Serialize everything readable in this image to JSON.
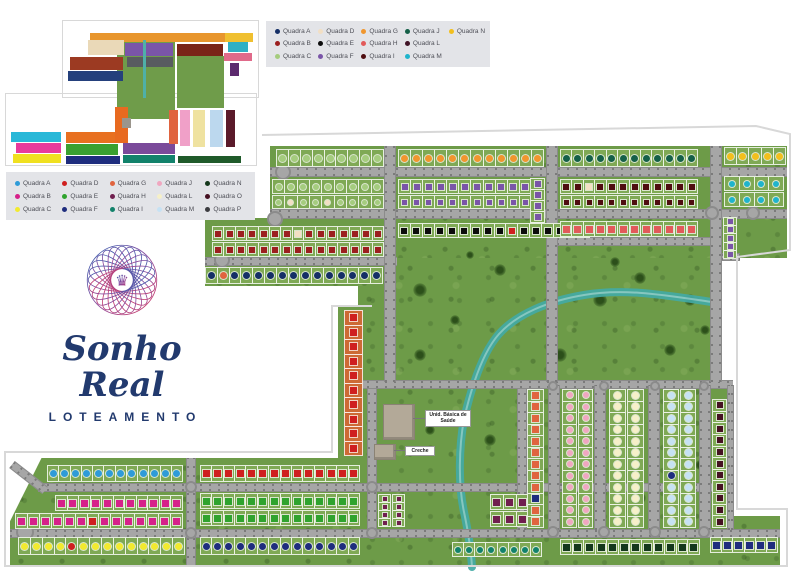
{
  "logo": {
    "title": "Sonho Real",
    "subtitle": "LOTEAMENTO",
    "accent": "#223a6e"
  },
  "map_labels": {
    "health_unit": "Unid. Básica de Saúde",
    "daycare": "Creche"
  },
  "legend_top": {
    "items": [
      {
        "label": "Quadra A",
        "color": "#152f66"
      },
      {
        "label": "Quadra B",
        "color": "#9c1f1f"
      },
      {
        "label": "Quadra C",
        "color": "#a5cc7e"
      },
      {
        "label": "Quadra D",
        "color": "#f2dfc4"
      },
      {
        "label": "Quadra E",
        "color": "#0c0c0c"
      },
      {
        "label": "Quadra F",
        "color": "#7a55a8"
      },
      {
        "label": "Quadra G",
        "color": "#f0962e"
      },
      {
        "label": "Quadra H",
        "color": "#e25a5a"
      },
      {
        "label": "Quadra I",
        "color": "#4f0d10"
      },
      {
        "label": "Quadra J",
        "color": "#156048"
      },
      {
        "label": "Quadra L",
        "color": "#401325"
      },
      {
        "label": "Quadra M",
        "color": "#1fb4cc"
      },
      {
        "label": "Quadra N",
        "color": "#f2bf1d"
      }
    ]
  },
  "legend_left": {
    "items": [
      {
        "label": "Quadra A",
        "color": "#2e9bd8"
      },
      {
        "label": "Quadra B",
        "color": "#d6218a"
      },
      {
        "label": "Quadra C",
        "color": "#f2ea2f"
      },
      {
        "label": "Quadra D",
        "color": "#cf1f1f"
      },
      {
        "label": "Quadra E",
        "color": "#2fa32e"
      },
      {
        "label": "Quadra F",
        "color": "#1f2d7e"
      },
      {
        "label": "Quadra G",
        "color": "#e0643f"
      },
      {
        "label": "Quadra H",
        "color": "#701f4f"
      },
      {
        "label": "Quadra I",
        "color": "#12826b"
      },
      {
        "label": "Quadra J",
        "color": "#f0a7c0"
      },
      {
        "label": "Quadra L",
        "color": "#f6f0c8"
      },
      {
        "label": "Quadra M",
        "color": "#c6e2f4"
      },
      {
        "label": "Quadra N",
        "color": "#14381c"
      },
      {
        "label": "Quadra O",
        "color": "#451122"
      },
      {
        "label": "Quadra P",
        "color": "#3c3c40"
      }
    ]
  },
  "inset": {
    "blocks": [
      {
        "color": "#6f9c4a",
        "x": 117,
        "y": 38,
        "w": 58,
        "h": 72
      },
      {
        "color": "#6f9c4a",
        "x": 177,
        "y": 56,
        "w": 47,
        "h": 52
      },
      {
        "color": "#6f9c4a",
        "x": 125,
        "y": 95,
        "w": 50,
        "h": 24
      },
      {
        "color": "#e8962e",
        "x": 90,
        "y": 33,
        "w": 135,
        "h": 9
      },
      {
        "color": "#f0c030",
        "x": 225,
        "y": 33,
        "w": 28,
        "h": 9
      },
      {
        "color": "#ead9b8",
        "x": 88,
        "y": 40,
        "w": 36,
        "h": 15
      },
      {
        "color": "#7a55a8",
        "x": 125,
        "y": 43,
        "w": 48,
        "h": 13
      },
      {
        "color": "#585c60",
        "x": 127,
        "y": 57,
        "w": 46,
        "h": 10
      },
      {
        "color": "#9c3a22",
        "x": 70,
        "y": 57,
        "w": 53,
        "h": 13
      },
      {
        "color": "#24407c",
        "x": 68,
        "y": 71,
        "w": 55,
        "h": 10
      },
      {
        "color": "#7a2418",
        "x": 177,
        "y": 44,
        "w": 46,
        "h": 12
      },
      {
        "color": "#2fb0c4",
        "x": 228,
        "y": 42,
        "w": 20,
        "h": 10
      },
      {
        "color": "#e06a8a",
        "x": 224,
        "y": 53,
        "w": 28,
        "h": 8
      },
      {
        "color": "#5c2a6e",
        "x": 230,
        "y": 63,
        "w": 9,
        "h": 13
      },
      {
        "color": "#4fb0a8",
        "x": 143,
        "y": 40,
        "w": 3,
        "h": 58
      },
      {
        "color": "#29b8d8",
        "x": 11,
        "y": 132,
        "w": 50,
        "h": 10
      },
      {
        "color": "#e83a9c",
        "x": 16,
        "y": 143,
        "w": 45,
        "h": 10
      },
      {
        "color": "#f0e020",
        "x": 13,
        "y": 154,
        "w": 48,
        "h": 9
      },
      {
        "color": "#e87020",
        "x": 66,
        "y": 132,
        "w": 52,
        "h": 11
      },
      {
        "color": "#3aa030",
        "x": 66,
        "y": 144,
        "w": 52,
        "h": 11
      },
      {
        "color": "#1f2d7e",
        "x": 66,
        "y": 156,
        "w": 54,
        "h": 8
      },
      {
        "color": "#e86a20",
        "x": 115,
        "y": 107,
        "w": 13,
        "h": 36
      },
      {
        "color": "#7a4a9a",
        "x": 123,
        "y": 143,
        "w": 52,
        "h": 11
      },
      {
        "color": "#12826b",
        "x": 123,
        "y": 155,
        "w": 52,
        "h": 8
      },
      {
        "color": "#e0643f",
        "x": 169,
        "y": 110,
        "w": 9,
        "h": 34
      },
      {
        "color": "#f0a0c8",
        "x": 180,
        "y": 110,
        "w": 10,
        "h": 36
      },
      {
        "color": "#efe2a0",
        "x": 193,
        "y": 110,
        "w": 12,
        "h": 37
      },
      {
        "color": "#bcd8ee",
        "x": 210,
        "y": 110,
        "w": 13,
        "h": 37
      },
      {
        "color": "#5a1a2a",
        "x": 226,
        "y": 110,
        "w": 9,
        "h": 37
      },
      {
        "color": "#1f5a2a",
        "x": 178,
        "y": 156,
        "w": 63,
        "h": 7
      },
      {
        "color": "#9a958c",
        "x": 122,
        "y": 118,
        "w": 9,
        "h": 10
      }
    ]
  },
  "map": {
    "colors": {
      "field": "#6d9b48",
      "road": "#a6a6a6",
      "river": "#43aaa5",
      "outline": "#d8d8d8"
    },
    "river_path": "M712,302 C664,295 624,288 584,295 C548,301 517,314 499,334 C482,353 471,389 464,419 C459,447 458,484 464,512 C468,531 471,550 472,567",
    "outline_path": "M262,135 L756,126 L790,134 L790,250 L737,257 L737,509 L787,509 L787,566 L5,566 L5,452 L332,452 L332,306 L372,306",
    "areas": [
      {
        "x": 270,
        "y": 146,
        "w": 517,
        "h": 112
      },
      {
        "x": 358,
        "y": 258,
        "w": 364,
        "h": 124
      },
      {
        "x": 205,
        "y": 218,
        "w": 182,
        "h": 68
      },
      {
        "x": 358,
        "y": 382,
        "w": 375,
        "h": 185
      },
      {
        "x": 10,
        "y": 458,
        "w": 350,
        "h": 109,
        "clip": "polygon(0 58%, 9% 0, 100% 0, 100% 100%, 0 100%)"
      },
      {
        "x": 338,
        "y": 306,
        "w": 28,
        "h": 152
      },
      {
        "x": 733,
        "y": 516,
        "w": 47,
        "h": 51
      }
    ],
    "trees": [
      {
        "x": 420,
        "y": 290,
        "r": 7
      },
      {
        "x": 455,
        "y": 320,
        "r": 5
      },
      {
        "x": 500,
        "y": 270,
        "r": 6
      },
      {
        "x": 470,
        "y": 255,
        "r": 4
      },
      {
        "x": 600,
        "y": 300,
        "r": 7
      },
      {
        "x": 640,
        "y": 278,
        "r": 6
      },
      {
        "x": 615,
        "y": 262,
        "r": 5
      },
      {
        "x": 690,
        "y": 300,
        "r": 6
      },
      {
        "x": 670,
        "y": 350,
        "r": 6
      },
      {
        "x": 560,
        "y": 355,
        "r": 7
      },
      {
        "x": 420,
        "y": 355,
        "r": 6
      },
      {
        "x": 390,
        "y": 335,
        "r": 5
      },
      {
        "x": 430,
        "y": 430,
        "r": 5
      },
      {
        "x": 490,
        "y": 440,
        "r": 6
      },
      {
        "x": 530,
        "y": 468,
        "r": 5
      },
      {
        "x": 600,
        "y": 458,
        "r": 6
      },
      {
        "x": 640,
        "y": 498,
        "r": 6
      },
      {
        "x": 615,
        "y": 430,
        "r": 4
      },
      {
        "x": 700,
        "y": 465,
        "r": 5
      },
      {
        "x": 705,
        "y": 330,
        "r": 5
      }
    ],
    "roads": [
      {
        "x": 270,
        "y": 167,
        "w": 517,
        "h": 10,
        "dir": "h"
      },
      {
        "x": 270,
        "y": 209,
        "w": 517,
        "h": 10,
        "dir": "h"
      },
      {
        "x": 205,
        "y": 257,
        "w": 192,
        "h": 9,
        "dir": "h"
      },
      {
        "x": 548,
        "y": 237,
        "w": 162,
        "h": 9,
        "dir": "h"
      },
      {
        "x": 712,
        "y": 253,
        "w": 28,
        "h": 8,
        "dir": "h"
      },
      {
        "x": 358,
        "y": 380,
        "w": 375,
        "h": 9,
        "dir": "h"
      },
      {
        "x": 38,
        "y": 483,
        "w": 695,
        "h": 9,
        "dir": "h"
      },
      {
        "x": 10,
        "y": 529,
        "w": 770,
        "h": 9,
        "dir": "h"
      },
      {
        "x": 12,
        "y": 460,
        "w": 42,
        "h": 9,
        "dir": "h",
        "rot": 38
      },
      {
        "x": 384,
        "y": 146,
        "w": 12,
        "h": 236,
        "dir": "v"
      },
      {
        "x": 546,
        "y": 146,
        "w": 12,
        "h": 236,
        "dir": "v"
      },
      {
        "x": 710,
        "y": 146,
        "w": 12,
        "h": 236,
        "dir": "v"
      },
      {
        "x": 367,
        "y": 389,
        "w": 10,
        "h": 141,
        "dir": "v"
      },
      {
        "x": 517,
        "y": 389,
        "w": 10,
        "h": 141,
        "dir": "v"
      },
      {
        "x": 548,
        "y": 385,
        "w": 12,
        "h": 145,
        "dir": "v"
      },
      {
        "x": 594,
        "y": 385,
        "w": 12,
        "h": 145,
        "dir": "v"
      },
      {
        "x": 648,
        "y": 385,
        "w": 12,
        "h": 145,
        "dir": "v"
      },
      {
        "x": 699,
        "y": 385,
        "w": 12,
        "h": 145,
        "dir": "v"
      },
      {
        "x": 727,
        "y": 385,
        "w": 7,
        "h": 145,
        "dir": "v"
      },
      {
        "x": 186,
        "y": 458,
        "w": 10,
        "h": 109,
        "dir": "v"
      }
    ],
    "roundabouts": [
      {
        "x": 283,
        "y": 172,
        "r": 8
      },
      {
        "x": 275,
        "y": 219,
        "r": 8
      },
      {
        "x": 222,
        "y": 260,
        "r": 8
      },
      {
        "x": 753,
        "y": 213,
        "r": 7
      },
      {
        "x": 712,
        "y": 213,
        "r": 7
      },
      {
        "x": 25,
        "y": 532,
        "r": 9
      },
      {
        "x": 191,
        "y": 487,
        "r": 6
      },
      {
        "x": 191,
        "y": 533,
        "r": 6
      },
      {
        "x": 372,
        "y": 487,
        "r": 6
      },
      {
        "x": 372,
        "y": 533,
        "r": 6
      },
      {
        "x": 553,
        "y": 532,
        "r": 6
      },
      {
        "x": 604,
        "y": 532,
        "r": 6
      },
      {
        "x": 655,
        "y": 532,
        "r": 6
      },
      {
        "x": 704,
        "y": 532,
        "r": 6
      },
      {
        "x": 553,
        "y": 386,
        "r": 5
      },
      {
        "x": 604,
        "y": 386,
        "r": 5
      },
      {
        "x": 655,
        "y": 386,
        "r": 5
      },
      {
        "x": 704,
        "y": 386,
        "r": 5
      }
    ],
    "strips": [
      {
        "x": 276,
        "y": 149,
        "w": 108,
        "h": 18,
        "n": 9,
        "color": "#a5cc7e",
        "shape": "circle"
      },
      {
        "x": 398,
        "y": 149,
        "w": 146,
        "h": 18,
        "n": 12,
        "color": "#f0962e",
        "shape": "circle"
      },
      {
        "x": 560,
        "y": 149,
        "w": 138,
        "h": 18,
        "n": 12,
        "color": "#156048",
        "shape": "circle"
      },
      {
        "x": 724,
        "y": 147,
        "w": 62,
        "h": 18,
        "n": 5,
        "color": "#f2bf1d",
        "shape": "circle"
      },
      {
        "x": 272,
        "y": 179,
        "w": 112,
        "h": 15,
        "n": 9,
        "color": "#a5cc7e",
        "shape": "circle"
      },
      {
        "x": 272,
        "y": 195,
        "w": 112,
        "h": 14,
        "n": 9,
        "color": "#a5cc7e",
        "shape": "circle",
        "specials": {
          "1": "#f2dfc4",
          "4": "#f2dfc4"
        }
      },
      {
        "x": 398,
        "y": 179,
        "w": 146,
        "h": 15,
        "n": 12,
        "color": "#7a55a8",
        "shape": "square"
      },
      {
        "x": 398,
        "y": 195,
        "w": 146,
        "h": 14,
        "n": 12,
        "color": "#7a55a8",
        "shape": "square"
      },
      {
        "x": 560,
        "y": 179,
        "w": 138,
        "h": 15,
        "n": 12,
        "color": "#4f0d10",
        "shape": "square",
        "specials": {
          "2": "#f2dfc4"
        }
      },
      {
        "x": 560,
        "y": 195,
        "w": 138,
        "h": 14,
        "n": 12,
        "color": "#4f0d10",
        "shape": "square"
      },
      {
        "x": 724,
        "y": 176,
        "w": 60,
        "h": 15,
        "n": 4,
        "color": "#1fb4cc",
        "shape": "circle"
      },
      {
        "x": 724,
        "y": 192,
        "w": 60,
        "h": 15,
        "n": 4,
        "color": "#1fb4cc",
        "shape": "circle"
      },
      {
        "x": 530,
        "y": 178,
        "w": 15,
        "h": 56,
        "n": 5,
        "color": "#7a55a8",
        "shape": "square",
        "dir": "v"
      },
      {
        "x": 212,
        "y": 226,
        "w": 172,
        "h": 15,
        "n": 15,
        "color": "#9c1f1f",
        "shape": "square",
        "specials": {
          "7": "#f2dfc4"
        }
      },
      {
        "x": 212,
        "y": 242,
        "w": 172,
        "h": 15,
        "n": 15,
        "color": "#9c1f1f",
        "shape": "square"
      },
      {
        "x": 398,
        "y": 223,
        "w": 192,
        "h": 15,
        "n": 16,
        "color": "#0c0c0c",
        "shape": "square",
        "specials": {
          "9": "#cf1f1f"
        }
      },
      {
        "x": 560,
        "y": 221,
        "w": 138,
        "h": 16,
        "n": 12,
        "color": "#e25a5a",
        "shape": "square"
      },
      {
        "x": 723,
        "y": 217,
        "w": 14,
        "h": 42,
        "n": 5,
        "color": "#7a55a8",
        "shape": "square",
        "dir": "v"
      },
      {
        "x": 205,
        "y": 267,
        "w": 178,
        "h": 17,
        "n": 15,
        "color": "#152f66",
        "shape": "circle",
        "specials": {
          "1": "#e0643f"
        }
      },
      {
        "x": 344,
        "y": 310,
        "w": 19,
        "h": 146,
        "n": 10,
        "color": "#cf1f1f",
        "shape": "square",
        "dir": "v",
        "bg": "#cd6a35"
      },
      {
        "x": 47,
        "y": 465,
        "w": 136,
        "h": 17,
        "n": 12,
        "color": "#2e9bd8",
        "shape": "circle"
      },
      {
        "x": 200,
        "y": 465,
        "w": 160,
        "h": 17,
        "n": 14,
        "color": "#cf1f1f",
        "shape": "square"
      },
      {
        "x": 55,
        "y": 495,
        "w": 128,
        "h": 16,
        "n": 11,
        "color": "#d6218a",
        "shape": "square"
      },
      {
        "x": 15,
        "y": 513,
        "w": 168,
        "h": 16,
        "n": 14,
        "color": "#d6218a",
        "shape": "square",
        "specials": {
          "6": "#cf1f1f"
        }
      },
      {
        "x": 200,
        "y": 493,
        "w": 160,
        "h": 16,
        "n": 14,
        "color": "#2fa32e",
        "shape": "square"
      },
      {
        "x": 200,
        "y": 510,
        "w": 160,
        "h": 16,
        "n": 14,
        "color": "#2fa32e",
        "shape": "square"
      },
      {
        "x": 18,
        "y": 537,
        "w": 167,
        "h": 18,
        "n": 14,
        "color": "#f2ea2f",
        "shape": "circle",
        "specials": {
          "4": "#cf1f1f"
        }
      },
      {
        "x": 200,
        "y": 537,
        "w": 160,
        "h": 18,
        "n": 14,
        "color": "#1f2d7e",
        "shape": "circle"
      },
      {
        "x": 378,
        "y": 494,
        "w": 13,
        "h": 33,
        "n": 4,
        "color": "#701f4f",
        "shape": "square",
        "dir": "v"
      },
      {
        "x": 392,
        "y": 494,
        "w": 13,
        "h": 33,
        "n": 4,
        "color": "#701f4f",
        "shape": "square",
        "dir": "v"
      },
      {
        "x": 490,
        "y": 494,
        "w": 52,
        "h": 16,
        "n": 4,
        "color": "#701f4f",
        "shape": "square"
      },
      {
        "x": 490,
        "y": 511,
        "w": 52,
        "h": 16,
        "n": 4,
        "color": "#701f4f",
        "shape": "square"
      },
      {
        "x": 452,
        "y": 542,
        "w": 90,
        "h": 15,
        "n": 8,
        "color": "#12826b",
        "shape": "circle"
      },
      {
        "x": 527,
        "y": 389,
        "w": 17,
        "h": 139,
        "n": 12,
        "color": "#e0643f",
        "shape": "square",
        "dir": "v",
        "specials": {
          "9": "#1f2d7e"
        }
      },
      {
        "x": 562,
        "y": 389,
        "w": 15,
        "h": 139,
        "n": 12,
        "color": "#f0a7c0",
        "shape": "circle",
        "dir": "v"
      },
      {
        "x": 578,
        "y": 389,
        "w": 15,
        "h": 139,
        "n": 12,
        "color": "#f0a7c0",
        "shape": "circle",
        "dir": "v"
      },
      {
        "x": 609,
        "y": 389,
        "w": 17,
        "h": 139,
        "n": 12,
        "color": "#f6f0c8",
        "shape": "circle",
        "dir": "v"
      },
      {
        "x": 627,
        "y": 389,
        "w": 17,
        "h": 139,
        "n": 12,
        "color": "#f6f0c8",
        "shape": "circle",
        "dir": "v"
      },
      {
        "x": 663,
        "y": 389,
        "w": 16,
        "h": 139,
        "n": 12,
        "color": "#c6e2f4",
        "shape": "circle",
        "dir": "v",
        "specials": {
          "7": "#1f2d7e"
        }
      },
      {
        "x": 680,
        "y": 389,
        "w": 16,
        "h": 139,
        "n": 12,
        "color": "#c6e2f4",
        "shape": "circle",
        "dir": "v"
      },
      {
        "x": 712,
        "y": 399,
        "w": 15,
        "h": 129,
        "n": 11,
        "color": "#451122",
        "shape": "square",
        "dir": "v"
      },
      {
        "x": 560,
        "y": 539,
        "w": 140,
        "h": 16,
        "n": 12,
        "color": "#14381c",
        "shape": "square"
      },
      {
        "x": 710,
        "y": 537,
        "w": 68,
        "h": 16,
        "n": 6,
        "color": "#1f2d7e",
        "shape": "square"
      }
    ],
    "buildings": [
      {
        "x": 383,
        "y": 404,
        "w": 30,
        "h": 34
      },
      {
        "x": 374,
        "y": 444,
        "w": 20,
        "h": 14
      }
    ],
    "connectors": [
      {
        "x": 413,
        "y": 418,
        "w": 12
      },
      {
        "x": 394,
        "y": 450,
        "w": 11
      }
    ]
  }
}
